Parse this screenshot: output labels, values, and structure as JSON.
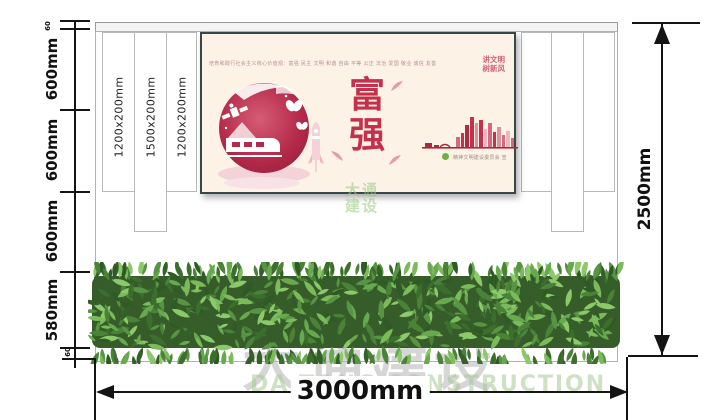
{
  "dimensions": {
    "left": {
      "labels": [
        "60",
        "600mm",
        "600mm",
        "600mm",
        "580mm",
        "60"
      ]
    },
    "right": {
      "label": "2500mm"
    },
    "bottom": {
      "label": "3000mm"
    }
  },
  "panels": {
    "labels": [
      "1200x200mm",
      "1500x200mm",
      "1200x200mm"
    ]
  },
  "poster": {
    "values_line": "培育和践行社会主义核心价值观：富强 民主 文明 和谐 自由 平等 公正 法治 爱国 敬业 诚信 友善",
    "slogan_line1": "讲文明",
    "slogan_line2": "树新风",
    "title_char1": "富",
    "title_char2": "强",
    "credit": "精神文明建设委员会 宣"
  },
  "watermark": {
    "logo_line1": "大通",
    "logo_line2": "建设",
    "cn": "大通建设",
    "en": "DA TONG CONSTRUCTION"
  },
  "colors": {
    "accent_red": "#c5314d",
    "poster_bg": "#fcf3e6",
    "frame": "#37474a",
    "hedge_green": "#4a8238",
    "pink": "#f3d2d8"
  }
}
